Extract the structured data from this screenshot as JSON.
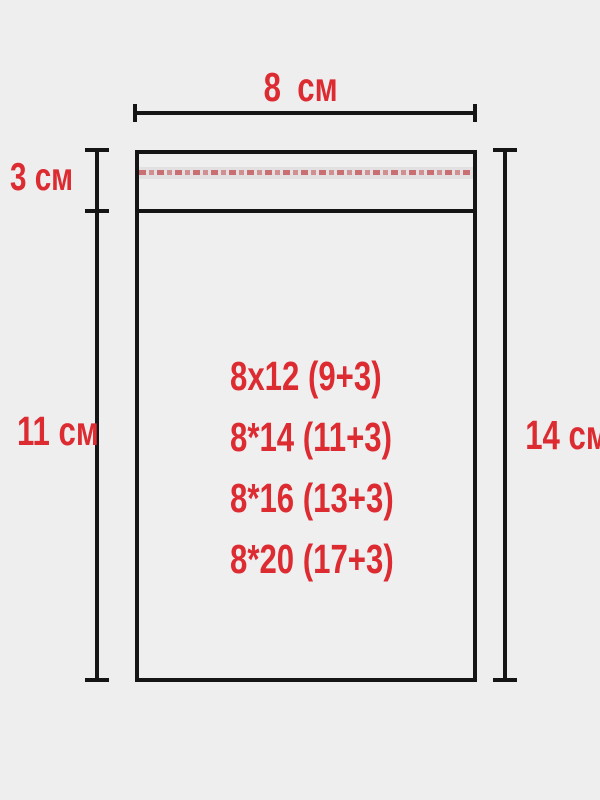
{
  "colors": {
    "accent_red": "#dc2b31",
    "line_black": "#151515",
    "background": "#efeeef",
    "strip_bg": "#e3e0e1"
  },
  "labels": {
    "top_width": "8 см",
    "flap_height": "3 см",
    "body_height": "11 см",
    "total_height": "14 см"
  },
  "bag_sizes": [
    "8x12 (9+3)",
    "8*14 (11+3)",
    "8*16 (13+3)",
    "8*20 (17+3)"
  ]
}
